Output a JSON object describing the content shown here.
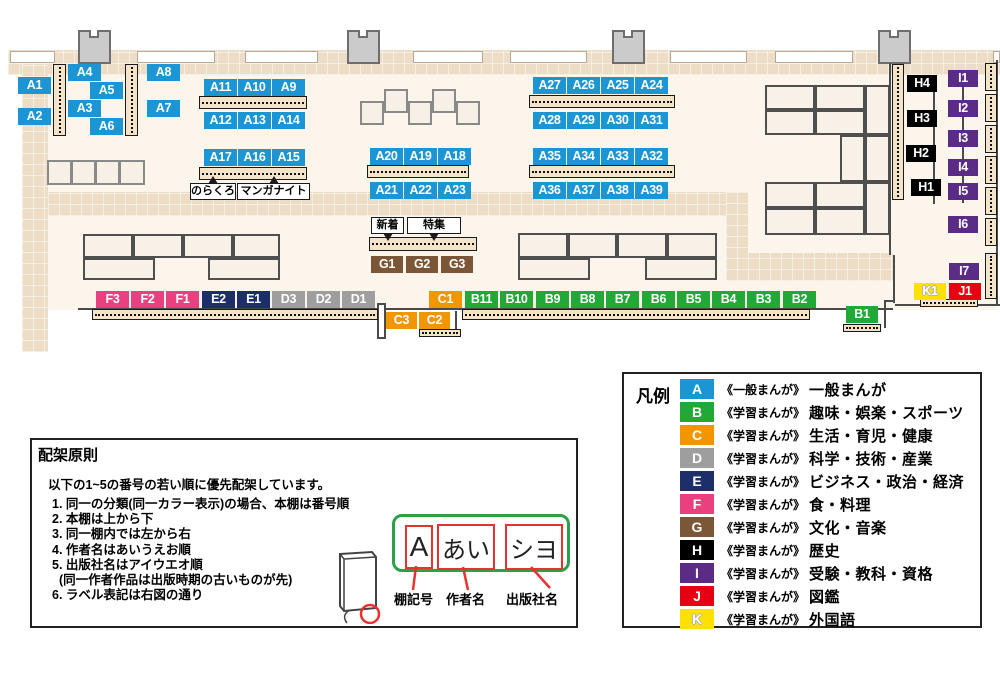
{
  "colors": {
    "A": "#1b95d4",
    "B": "#21a837",
    "C": "#f29600",
    "D": "#9e9e9f",
    "E": "#1d2f6b",
    "F": "#ea4080",
    "G": "#7b5738",
    "H": "#000000",
    "I": "#5b2c86",
    "J": "#e60012",
    "K": "#ffe100"
  },
  "map": {
    "labels": [
      {
        "id": "A1",
        "cat": "A",
        "x": 18,
        "y": 77
      },
      {
        "id": "A2",
        "cat": "A",
        "x": 18,
        "y": 108
      },
      {
        "id": "A4",
        "cat": "A",
        "x": 68,
        "y": 64
      },
      {
        "id": "A5",
        "cat": "A",
        "x": 90,
        "y": 82
      },
      {
        "id": "A3",
        "cat": "A",
        "x": 68,
        "y": 100
      },
      {
        "id": "A6",
        "cat": "A",
        "x": 90,
        "y": 118
      },
      {
        "id": "A8",
        "cat": "A",
        "x": 147,
        "y": 64
      },
      {
        "id": "A7",
        "cat": "A",
        "x": 147,
        "y": 100
      },
      {
        "id": "A11",
        "cat": "A",
        "x": 204,
        "y": 79
      },
      {
        "id": "A10",
        "cat": "A",
        "x": 238,
        "y": 79
      },
      {
        "id": "A9",
        "cat": "A",
        "x": 272,
        "y": 79
      },
      {
        "id": "A12",
        "cat": "A",
        "x": 204,
        "y": 112
      },
      {
        "id": "A13",
        "cat": "A",
        "x": 238,
        "y": 112
      },
      {
        "id": "A14",
        "cat": "A",
        "x": 272,
        "y": 112
      },
      {
        "id": "A17",
        "cat": "A",
        "x": 204,
        "y": 149
      },
      {
        "id": "A16",
        "cat": "A",
        "x": 238,
        "y": 149
      },
      {
        "id": "A15",
        "cat": "A",
        "x": 272,
        "y": 149
      },
      {
        "id": "A20",
        "cat": "A",
        "x": 370,
        "y": 148
      },
      {
        "id": "A19",
        "cat": "A",
        "x": 404,
        "y": 148
      },
      {
        "id": "A18",
        "cat": "A",
        "x": 438,
        "y": 148
      },
      {
        "id": "A21",
        "cat": "A",
        "x": 370,
        "y": 182
      },
      {
        "id": "A22",
        "cat": "A",
        "x": 404,
        "y": 182
      },
      {
        "id": "A23",
        "cat": "A",
        "x": 438,
        "y": 182
      },
      {
        "id": "A27",
        "cat": "A",
        "x": 533,
        "y": 77
      },
      {
        "id": "A26",
        "cat": "A",
        "x": 567,
        "y": 77
      },
      {
        "id": "A25",
        "cat": "A",
        "x": 601,
        "y": 77
      },
      {
        "id": "A24",
        "cat": "A",
        "x": 635,
        "y": 77
      },
      {
        "id": "A28",
        "cat": "A",
        "x": 533,
        "y": 112
      },
      {
        "id": "A29",
        "cat": "A",
        "x": 567,
        "y": 112
      },
      {
        "id": "A30",
        "cat": "A",
        "x": 601,
        "y": 112
      },
      {
        "id": "A31",
        "cat": "A",
        "x": 635,
        "y": 112
      },
      {
        "id": "A35",
        "cat": "A",
        "x": 533,
        "y": 148
      },
      {
        "id": "A34",
        "cat": "A",
        "x": 567,
        "y": 148
      },
      {
        "id": "A33",
        "cat": "A",
        "x": 601,
        "y": 148
      },
      {
        "id": "A32",
        "cat": "A",
        "x": 635,
        "y": 148
      },
      {
        "id": "A36",
        "cat": "A",
        "x": 533,
        "y": 182
      },
      {
        "id": "A37",
        "cat": "A",
        "x": 567,
        "y": 182
      },
      {
        "id": "A38",
        "cat": "A",
        "x": 601,
        "y": 182
      },
      {
        "id": "A39",
        "cat": "A",
        "x": 635,
        "y": 182
      },
      {
        "id": "G1",
        "cat": "G",
        "x": 371,
        "y": 256,
        "w": 32
      },
      {
        "id": "G2",
        "cat": "G",
        "x": 406,
        "y": 256,
        "w": 32
      },
      {
        "id": "G3",
        "cat": "G",
        "x": 441,
        "y": 256,
        "w": 32
      },
      {
        "id": "F3",
        "cat": "F",
        "x": 96,
        "y": 291
      },
      {
        "id": "F2",
        "cat": "F",
        "x": 131,
        "y": 291
      },
      {
        "id": "F1",
        "cat": "F",
        "x": 166,
        "y": 291
      },
      {
        "id": "E2",
        "cat": "E",
        "x": 202,
        "y": 291
      },
      {
        "id": "E1",
        "cat": "E",
        "x": 237,
        "y": 291
      },
      {
        "id": "D3",
        "cat": "D",
        "x": 272,
        "y": 291
      },
      {
        "id": "D2",
        "cat": "D",
        "x": 307,
        "y": 291
      },
      {
        "id": "D1",
        "cat": "D",
        "x": 342,
        "y": 291
      },
      {
        "id": "C1",
        "cat": "C",
        "x": 429,
        "y": 291
      },
      {
        "id": "B11",
        "cat": "B",
        "x": 465,
        "y": 291
      },
      {
        "id": "B10",
        "cat": "B",
        "x": 500,
        "y": 291
      },
      {
        "id": "B9",
        "cat": "B",
        "x": 536,
        "y": 291
      },
      {
        "id": "B8",
        "cat": "B",
        "x": 571,
        "y": 291
      },
      {
        "id": "B7",
        "cat": "B",
        "x": 606,
        "y": 291
      },
      {
        "id": "B6",
        "cat": "B",
        "x": 642,
        "y": 291
      },
      {
        "id": "B5",
        "cat": "B",
        "x": 677,
        "y": 291
      },
      {
        "id": "B4",
        "cat": "B",
        "x": 712,
        "y": 291
      },
      {
        "id": "B3",
        "cat": "B",
        "x": 747,
        "y": 291
      },
      {
        "id": "B2",
        "cat": "B",
        "x": 783,
        "y": 291
      },
      {
        "id": "C3",
        "cat": "C",
        "x": 386,
        "y": 312,
        "w": 31
      },
      {
        "id": "C2",
        "cat": "C",
        "x": 419,
        "y": 312,
        "w": 31
      },
      {
        "id": "B1",
        "cat": "B",
        "x": 846,
        "y": 306,
        "w": 32
      },
      {
        "id": "H4",
        "cat": "H",
        "x": 907,
        "y": 75,
        "w": 30
      },
      {
        "id": "H3",
        "cat": "H",
        "x": 907,
        "y": 110,
        "w": 30
      },
      {
        "id": "H2",
        "cat": "H",
        "x": 906,
        "y": 145,
        "w": 30
      },
      {
        "id": "H1",
        "cat": "H",
        "x": 911,
        "y": 179,
        "w": 30
      },
      {
        "id": "I1",
        "cat": "I",
        "x": 948,
        "y": 70,
        "w": 30
      },
      {
        "id": "I2",
        "cat": "I",
        "x": 948,
        "y": 100,
        "w": 30
      },
      {
        "id": "I3",
        "cat": "I",
        "x": 948,
        "y": 130,
        "w": 30
      },
      {
        "id": "I4",
        "cat": "I",
        "x": 948,
        "y": 159,
        "w": 30
      },
      {
        "id": "I5",
        "cat": "I",
        "x": 948,
        "y": 183,
        "w": 30
      },
      {
        "id": "I6",
        "cat": "I",
        "x": 948,
        "y": 216,
        "w": 30
      },
      {
        "id": "I7",
        "cat": "I",
        "x": 949,
        "y": 263,
        "w": 30
      },
      {
        "id": "K1",
        "cat": "K",
        "x": 914,
        "y": 283,
        "w": 32
      },
      {
        "id": "J1",
        "cat": "J",
        "x": 949,
        "y": 283,
        "w": 32
      }
    ],
    "tags": [
      {
        "text": "のらくろ",
        "x": 190,
        "y": 183,
        "w": 46,
        "dir": "up"
      },
      {
        "text": "マンガナイト",
        "x": 237,
        "y": 183,
        "w": 73,
        "dir": "up"
      },
      {
        "text": "新着",
        "x": 371,
        "y": 217,
        "w": 33,
        "dir": "down"
      },
      {
        "text": "特集",
        "x": 407,
        "y": 217,
        "w": 54,
        "dir": "down"
      }
    ]
  },
  "legend": {
    "title": "凡例",
    "items": [
      {
        "code": "A",
        "series": "《一般まんが》",
        "label": "一般まんが"
      },
      {
        "code": "B",
        "series": "《学習まんが》",
        "label": "趣味・娯楽・スポーツ"
      },
      {
        "code": "C",
        "series": "《学習まんが》",
        "label": "生活・育児・健康"
      },
      {
        "code": "D",
        "series": "《学習まんが》",
        "label": "科学・技術・産業"
      },
      {
        "code": "E",
        "series": "《学習まんが》",
        "label": "ビジネス・政治・経済"
      },
      {
        "code": "F",
        "series": "《学習まんが》",
        "label": "食・料理"
      },
      {
        "code": "G",
        "series": "《学習まんが》",
        "label": "文化・音楽"
      },
      {
        "code": "H",
        "series": "《学習まんが》",
        "label": "歴史"
      },
      {
        "code": "I",
        "series": "《学習まんが》",
        "label": "受験・教科・資格"
      },
      {
        "code": "J",
        "series": "《学習まんが》",
        "label": "図鑑"
      },
      {
        "code": "K",
        "series": "《学習まんが》",
        "label": "外国語"
      }
    ]
  },
  "rules": {
    "title": "配架原則",
    "intro": "以下の1~5の番号の若い順に優先配架しています。",
    "items": [
      "1. 同一の分類(同一カラー表示)の場合、本棚は番号順",
      "2. 本棚は上から下",
      "3. 同一棚内では左から右",
      "4. 作者名はあいうえお順",
      "5. 出版社名はアイウエオ順",
      "  (同一作者作品は出版時期の古いものが先)",
      "6. ラベル表記は右図の通り"
    ],
    "diagram": {
      "boxes": [
        "A",
        "あい",
        "シヨ"
      ],
      "captions": [
        "棚記号",
        "作者名",
        "出版社名"
      ]
    }
  }
}
